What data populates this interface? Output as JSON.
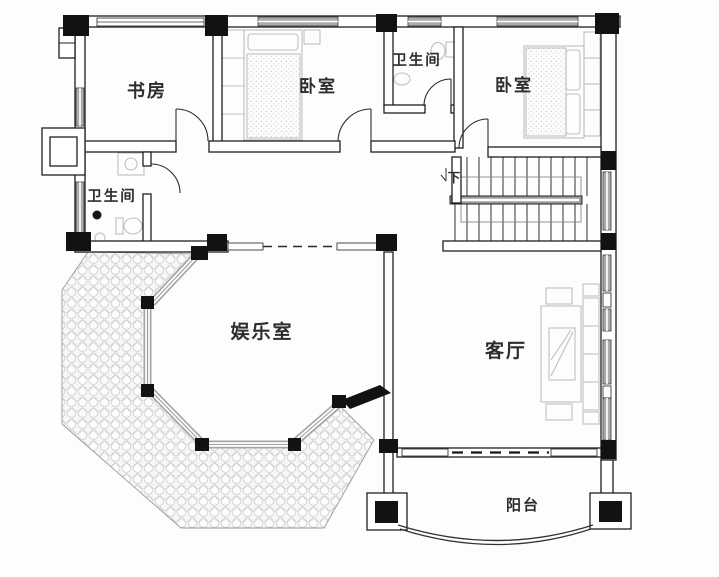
{
  "figure": {
    "type": "floor-plan",
    "language": "zh"
  },
  "rooms": {
    "study": {
      "label": "书房"
    },
    "bedroom_top": {
      "label": "卧室"
    },
    "bathroom_top": {
      "label": "卫生间"
    },
    "bedroom_right": {
      "label": "卧室"
    },
    "bathroom_left": {
      "label": "卫生间"
    },
    "entertainment": {
      "label": "娱乐室"
    },
    "living": {
      "label": "客厅"
    },
    "balcony": {
      "label": "阳台"
    }
  },
  "stairs": {
    "direction_label": "下"
  },
  "colors": {
    "background": "#fdfdfd",
    "wall_line": "#1f1f1f",
    "column_fill": "#121212",
    "window_fill": "#ababab",
    "furniture_line": "#bfbfbf",
    "terrace_hatch": "#c8c8c8"
  }
}
